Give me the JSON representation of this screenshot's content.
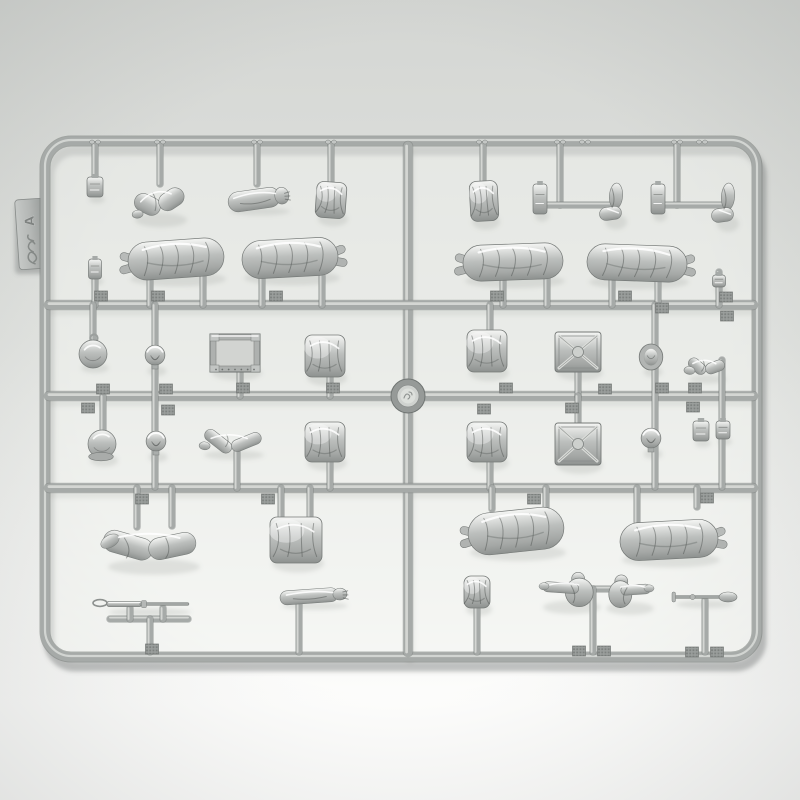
{
  "meta": {
    "description": "Photograph of a gray injection-molded polystyrene model-kit sprue (runner frame) holding 1/35-scale soldier figure parts: greatcoat bodies, arms, legs, heads, helmets, canteen, ammunition crates and a rifle.",
    "tag": {
      "sprue_letter": "A"
    }
  },
  "palette": {
    "bg_top": "#d4d6d3",
    "bg_mid": "#e1e3e0",
    "bg_bottom": "#fdfdfc",
    "panel": "#f2f4f0",
    "runner": "#a6aaa8",
    "runner_hi": "#d7d9d6",
    "runner_dk": "#767b79",
    "plastic_light": "#f5f6f4",
    "plastic_mid": "#bcbfbd",
    "plastic_dark": "#8d918f",
    "shadow": "#6e7371",
    "tag_fill": "#b4b7b5",
    "emboss": "#84888680"
  },
  "frame": {
    "x": 45,
    "y": 141,
    "w": 712,
    "h": 516,
    "r": 26,
    "stroke_w": 9
  },
  "boss": {
    "x": 408,
    "y": 396,
    "r_outer": 17,
    "r_mid": 11,
    "r_inner": 7.5
  },
  "tag": {
    "x": 31,
    "y": 234,
    "w": 28,
    "h": 70,
    "rot": -4
  },
  "runners": [
    [
      408,
      146,
      408,
      652
    ],
    [
      49,
      305,
      753,
      305
    ],
    [
      49,
      396,
      753,
      396
    ],
    [
      49,
      488,
      753,
      488
    ]
  ],
  "stubs": [
    [
      95,
      145,
      95,
      179
    ],
    [
      160,
      145,
      160,
      184
    ],
    [
      257,
      145,
      257,
      184
    ],
    [
      331,
      145,
      331,
      184
    ],
    [
      483,
      145,
      483,
      182
    ],
    [
      560,
      145,
      560,
      205
    ],
    [
      545,
      205,
      612,
      205
    ],
    [
      677,
      145,
      677,
      205
    ],
    [
      660,
      205,
      727,
      205
    ],
    [
      150,
      276,
      150,
      305
    ],
    [
      203,
      276,
      203,
      305
    ],
    [
      262,
      276,
      262,
      305
    ],
    [
      322,
      276,
      322,
      305
    ],
    [
      503,
      278,
      503,
      305
    ],
    [
      547,
      278,
      547,
      305
    ],
    [
      612,
      280,
      612,
      305
    ],
    [
      658,
      280,
      658,
      305
    ],
    [
      719,
      272,
      719,
      305
    ],
    [
      95,
      280,
      95,
      305
    ],
    [
      93,
      305,
      93,
      342
    ],
    [
      155,
      305,
      155,
      487
    ],
    [
      240,
      370,
      240,
      396
    ],
    [
      330,
      375,
      330,
      396
    ],
    [
      103,
      396,
      103,
      430
    ],
    [
      237,
      452,
      237,
      488
    ],
    [
      330,
      460,
      330,
      488
    ],
    [
      490,
      305,
      490,
      331
    ],
    [
      490,
      460,
      490,
      488
    ],
    [
      578,
      370,
      578,
      396
    ],
    [
      578,
      396,
      578,
      424
    ],
    [
      655,
      305,
      655,
      487
    ],
    [
      722,
      360,
      722,
      487
    ],
    [
      137,
      488,
      137,
      527
    ],
    [
      172,
      488,
      172,
      526
    ],
    [
      281,
      488,
      281,
      518
    ],
    [
      310,
      488,
      310,
      518
    ],
    [
      492,
      488,
      492,
      509
    ],
    [
      546,
      488,
      546,
      521
    ],
    [
      637,
      488,
      637,
      522
    ],
    [
      697,
      488,
      697,
      507
    ],
    [
      110,
      619,
      188,
      619
    ],
    [
      130,
      608,
      130,
      619
    ],
    [
      163,
      608,
      163,
      619
    ],
    [
      150,
      619,
      150,
      652
    ],
    [
      299,
      600,
      299,
      652
    ],
    [
      477,
      606,
      477,
      652
    ],
    [
      575,
      589,
      610,
      589
    ],
    [
      593,
      589,
      593,
      652
    ],
    [
      705,
      600,
      705,
      652
    ]
  ],
  "tabs": [
    [
      101,
      296
    ],
    [
      158,
      296
    ],
    [
      276,
      296
    ],
    [
      497,
      296
    ],
    [
      625,
      296
    ],
    [
      103,
      389
    ],
    [
      88,
      408
    ],
    [
      166,
      389
    ],
    [
      168,
      410
    ],
    [
      243,
      388
    ],
    [
      333,
      388
    ],
    [
      484,
      409
    ],
    [
      506,
      388
    ],
    [
      572,
      408
    ],
    [
      605,
      389
    ],
    [
      662,
      308
    ],
    [
      662,
      388
    ],
    [
      695,
      388
    ],
    [
      693,
      407
    ],
    [
      726,
      297
    ],
    [
      727,
      316
    ],
    [
      142,
      499
    ],
    [
      268,
      499
    ],
    [
      534,
      499
    ],
    [
      707,
      498
    ],
    [
      152,
      649
    ],
    [
      579,
      651
    ],
    [
      604,
      651
    ],
    [
      692,
      652
    ],
    [
      717,
      652
    ]
  ],
  "frame_marks": [
    95,
    160,
    257,
    331,
    482,
    560,
    585,
    677,
    702
  ],
  "parts": [
    {
      "n": "small-hand-part",
      "t": "small",
      "x": 95,
      "y": 187,
      "w": 16,
      "h": 20
    },
    {
      "n": "bent-arms-pair",
      "t": "armbent",
      "x": 159,
      "y": 201,
      "w": 52,
      "h": 36,
      "r": -8
    },
    {
      "n": "arms-with-hands",
      "t": "arm",
      "x": 258,
      "y": 199,
      "w": 60,
      "h": 20,
      "r": -8
    },
    {
      "n": "folded-cap",
      "t": "jacket",
      "x": 331,
      "y": 200,
      "w": 30,
      "h": 36,
      "r": 4
    },
    {
      "n": "greatcoat-torso",
      "t": "body",
      "x": 176,
      "y": 259,
      "w": 96,
      "h": 38,
      "r": -4,
      "boots": "left"
    },
    {
      "n": "greatcoat-torso",
      "t": "body",
      "x": 290,
      "y": 258,
      "w": 96,
      "h": 38,
      "r": -3,
      "boots": "right"
    },
    {
      "n": "small-pistol-part",
      "t": "small",
      "x": 95,
      "y": 269,
      "w": 13,
      "h": 20
    },
    {
      "n": "folded-collar",
      "t": "jacket",
      "x": 484,
      "y": 201,
      "w": 28,
      "h": 40,
      "r": -3
    },
    {
      "n": "hand-part",
      "t": "small",
      "x": 540,
      "y": 199,
      "w": 14,
      "h": 30
    },
    {
      "n": "boot-leg",
      "t": "boot",
      "x": 614,
      "y": 202,
      "w": 22,
      "h": 38
    },
    {
      "n": "hand-part",
      "t": "small",
      "x": 658,
      "y": 199,
      "w": 14,
      "h": 30
    },
    {
      "n": "boot-leg",
      "t": "boot",
      "x": 726,
      "y": 203,
      "w": 22,
      "h": 40
    },
    {
      "n": "lying-greatcoat-body",
      "t": "body",
      "x": 513,
      "y": 262,
      "w": 100,
      "h": 36,
      "r": -2,
      "boots": "left"
    },
    {
      "n": "lying-greatcoat-body",
      "t": "body",
      "x": 637,
      "y": 263,
      "w": 100,
      "h": 36,
      "r": 2,
      "boots": "right"
    },
    {
      "n": "small-box",
      "t": "small",
      "x": 719,
      "y": 281,
      "w": 13,
      "h": 12
    },
    {
      "n": "canteen",
      "t": "flask",
      "x": 93,
      "y": 354,
      "w": 28,
      "h": 24,
      "loop": true
    },
    {
      "n": "helmet-head",
      "t": "head",
      "x": 155,
      "y": 357,
      "w": 19,
      "h": 24
    },
    {
      "n": "ammo-crate-open",
      "t": "crate",
      "x": 235,
      "y": 353,
      "w": 50,
      "h": 38
    },
    {
      "n": "folded-coat",
      "t": "jacket",
      "x": 325,
      "y": 356,
      "w": 40,
      "h": 42
    },
    {
      "n": "mess-tin",
      "t": "flask",
      "x": 102,
      "y": 444,
      "w": 28,
      "h": 30,
      "rim": true
    },
    {
      "n": "head-face",
      "t": "head",
      "x": 156,
      "y": 443,
      "w": 19,
      "h": 24
    },
    {
      "n": "draped-scarf",
      "t": "armbent",
      "x": 232,
      "y": 441,
      "w": 60,
      "h": 24,
      "r": 4
    },
    {
      "n": "folded-coat",
      "t": "jacket",
      "x": 325,
      "y": 442,
      "w": 40,
      "h": 40
    },
    {
      "n": "folded-tent",
      "t": "jacket",
      "x": 487,
      "y": 351,
      "w": 40,
      "h": 42
    },
    {
      "n": "ammo-box-lid-cross",
      "t": "boxx",
      "x": 578,
      "y": 352,
      "w": 46,
      "h": 40
    },
    {
      "n": "head-in-oval",
      "t": "headoval",
      "x": 651,
      "y": 357,
      "w": 19,
      "h": 26
    },
    {
      "n": "arm-pointing",
      "t": "armbent",
      "x": 706,
      "y": 366,
      "w": 38,
      "h": 22,
      "r": 6
    },
    {
      "n": "folded-tent",
      "t": "jacket",
      "x": 487,
      "y": 442,
      "w": 40,
      "h": 40
    },
    {
      "n": "ammo-box-lid-cross",
      "t": "boxx",
      "x": 578,
      "y": 444,
      "w": 46,
      "h": 42
    },
    {
      "n": "head-face",
      "t": "head",
      "x": 651,
      "y": 440,
      "w": 19,
      "h": 24
    },
    {
      "n": "boot-pair",
      "t": "small",
      "x": 701,
      "y": 431,
      "w": 16,
      "h": 20
    },
    {
      "n": "boot-pair",
      "t": "small",
      "x": 723,
      "y": 430,
      "w": 14,
      "h": 18
    },
    {
      "n": "bent-legs",
      "t": "legs",
      "x": 152,
      "y": 546,
      "w": 92,
      "h": 40
    },
    {
      "n": "folded-trousers",
      "t": "jacket",
      "x": 296,
      "y": 540,
      "w": 52,
      "h": 46
    },
    {
      "n": "rifle-with-sling",
      "t": "rifle",
      "x": 148,
      "y": 604,
      "w": 82,
      "h": 10
    },
    {
      "n": "extended-arm",
      "t": "arm",
      "x": 313,
      "y": 596,
      "w": 66,
      "h": 14,
      "r": -4
    },
    {
      "n": "walking-greatcoat-figure",
      "t": "body",
      "x": 516,
      "y": 531,
      "w": 96,
      "h": 42,
      "r": -6,
      "boots": "left"
    },
    {
      "n": "greatcoat-figure",
      "t": "body",
      "x": 669,
      "y": 540,
      "w": 98,
      "h": 38,
      "r": -3,
      "boots": "right"
    },
    {
      "n": "pouch",
      "t": "jacket",
      "x": 477,
      "y": 592,
      "w": 26,
      "h": 32
    },
    {
      "n": "torso-pointing-arm",
      "t": "torsoarm",
      "x": 570,
      "y": 589,
      "w": 58,
      "h": 34
    },
    {
      "n": "torso-pointing-arm",
      "t": "torsoarm",
      "x": 628,
      "y": 591,
      "w": 48,
      "h": 32,
      "flip": true
    },
    {
      "n": "entrenching-tool",
      "t": "tool",
      "x": 703,
      "y": 597,
      "w": 58,
      "h": 8
    }
  ]
}
